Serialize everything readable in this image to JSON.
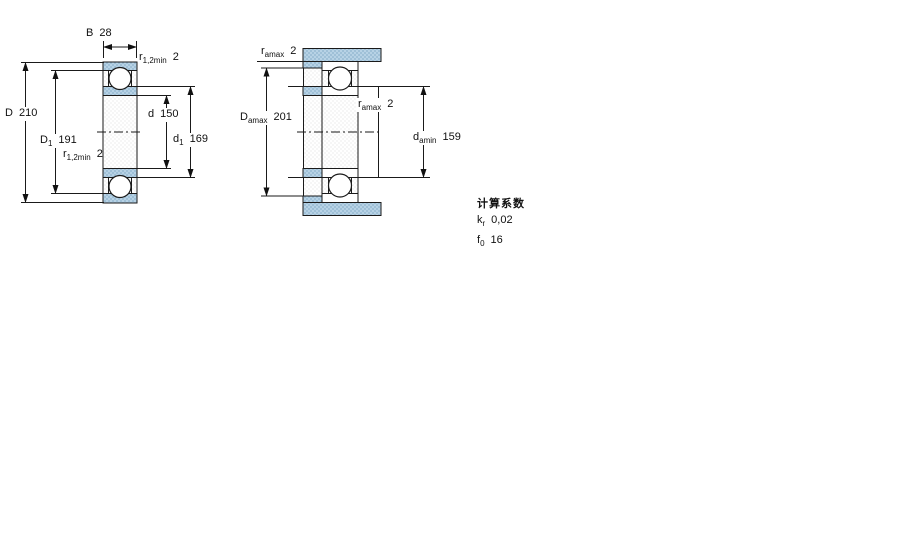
{
  "colors": {
    "steel_blue": "#b7d2e5",
    "steel_dot": "#8db3cd",
    "dither_dot": "#ececec",
    "line": "#1a1a1a"
  },
  "left_diagram": {
    "width_dim": {
      "symbol": "B",
      "value": "28"
    },
    "r_top": {
      "symbol": "r",
      "subscript": "1,2min",
      "value": "2"
    },
    "outer_dia": {
      "symbol": "D",
      "value": "210"
    },
    "shoulder_outer": {
      "symbol": "D",
      "subscript": "1",
      "value": "191"
    },
    "r_mid": {
      "symbol": "r",
      "subscript": "1,2min",
      "value": "2"
    },
    "bore_dia": {
      "symbol": "d",
      "value": "150"
    },
    "shoulder_inner": {
      "symbol": "d",
      "subscript": "1",
      "value": "169"
    }
  },
  "right_diagram": {
    "r_top": {
      "symbol": "r",
      "subscript": "amax",
      "value": "2"
    },
    "housing_dia": {
      "symbol": "D",
      "subscript": "amax",
      "value": "201"
    },
    "r_inner": {
      "symbol": "r",
      "subscript": "amax",
      "value": "2"
    },
    "shaft_dia": {
      "symbol": "d",
      "subscript": "amin",
      "value": "159"
    }
  },
  "calculation_factors": {
    "title": "计算系数",
    "rows": [
      {
        "symbol": "k",
        "subscript": "r",
        "value": "0,02"
      },
      {
        "symbol": "f",
        "subscript": "0",
        "value": "16"
      }
    ]
  }
}
